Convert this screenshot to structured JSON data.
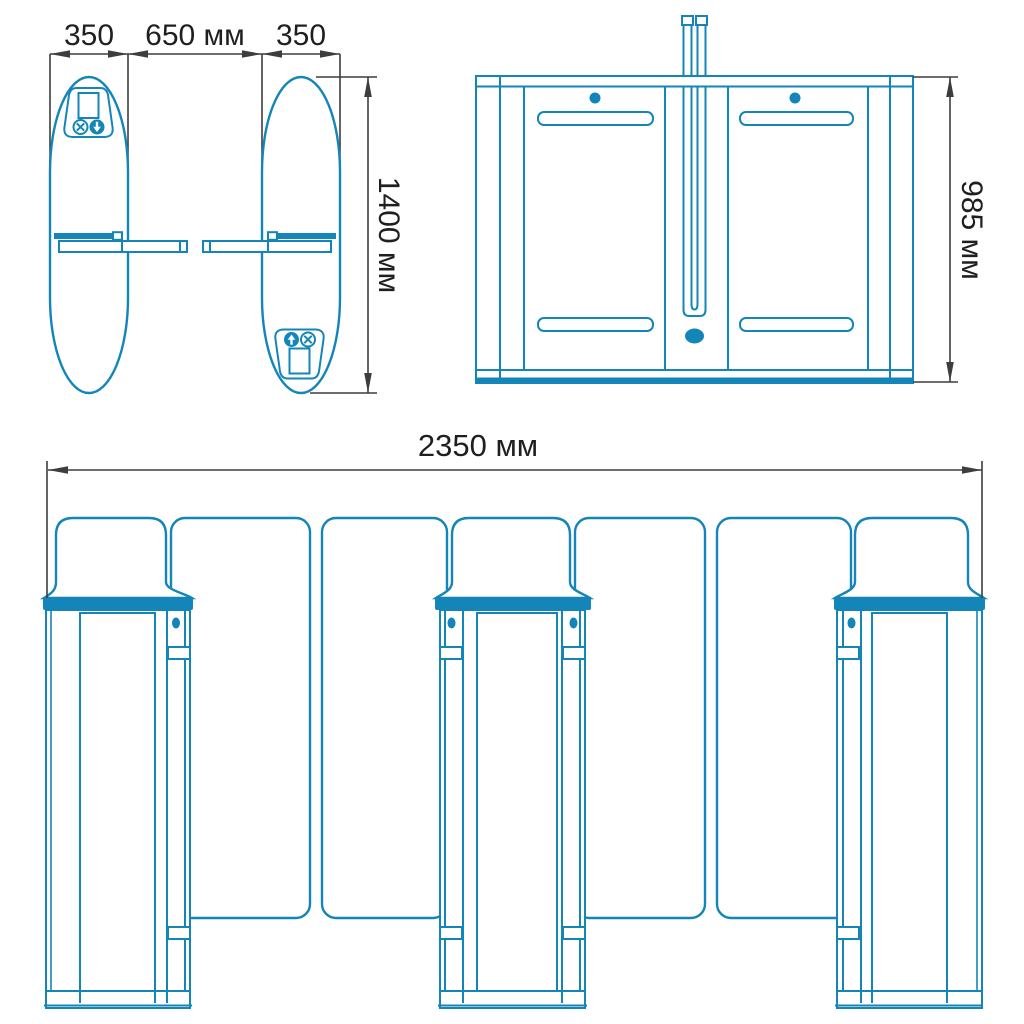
{
  "drawing": {
    "type": "turnstile-technical-drawing",
    "views": [
      "plan-view",
      "side-view",
      "front-view"
    ],
    "dimensions": {
      "pedestal_width_left": "350",
      "passage_width": "650 мм",
      "pedestal_width_right": "350",
      "pedestal_length": "1400 мм",
      "housing_height": "985 мм",
      "total_width": "2350 мм"
    },
    "icons": {
      "no_entry": "x-circle-icon",
      "entry_allowed": "arrow-circle-icon",
      "display": "screen-rect"
    },
    "colors": {
      "line_blue": "#1485b8",
      "dimension_line": "#3d3d3d",
      "label_text": "#1f1f1f",
      "background": "#ffffff"
    }
  }
}
